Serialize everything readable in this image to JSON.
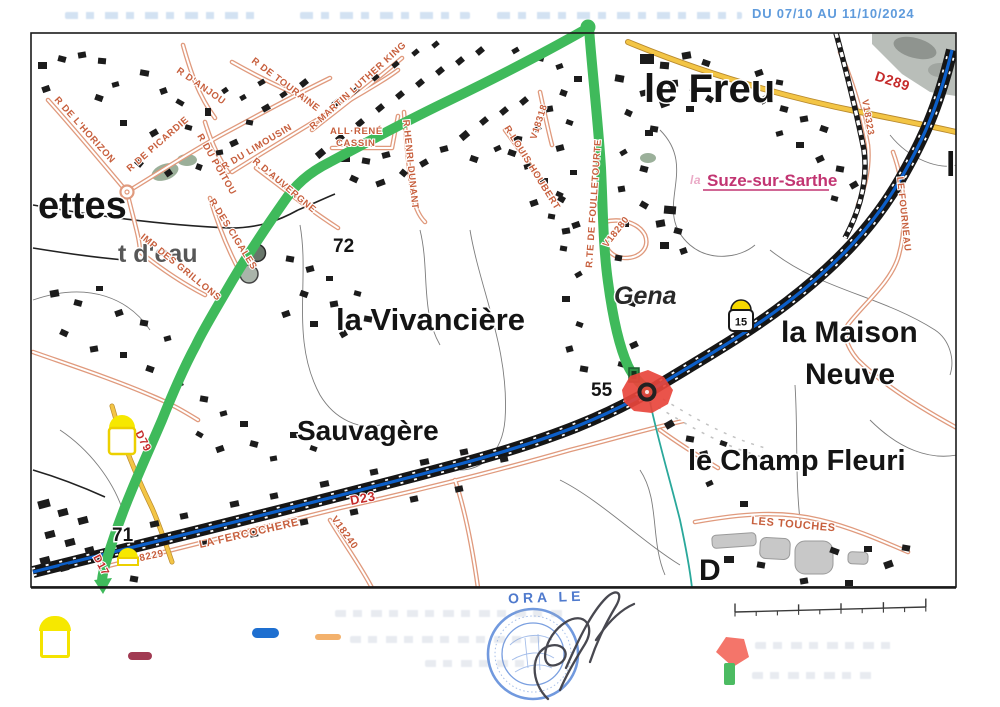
{
  "header": {
    "date_text": "DU 07/10 AU 11/10/2024"
  },
  "stamp": {
    "text": "ORA LE"
  },
  "map": {
    "labels": [
      {
        "t": "ettes",
        "x": 38,
        "y": 218,
        "s": 38,
        "c": "#141414"
      },
      {
        "t": "t d'eau",
        "x": 118,
        "y": 262,
        "s": 25,
        "c": "#575757"
      },
      {
        "t": "le Freu",
        "x": 644,
        "y": 102,
        "s": 40,
        "c": "#141414"
      },
      {
        "t": "72",
        "x": 333,
        "y": 252,
        "s": 19,
        "c": "#141414"
      },
      {
        "t": "la Vivancière",
        "x": 336,
        "y": 330,
        "s": 31,
        "c": "#141414"
      },
      {
        "t": "Gena",
        "x": 614,
        "y": 304,
        "s": 25,
        "c": "#2a2a2a",
        "i": true
      },
      {
        "t": "55",
        "x": 591,
        "y": 396,
        "s": 19,
        "c": "#141414"
      },
      {
        "t": "la Maison",
        "x": 781,
        "y": 342,
        "s": 30,
        "c": "#141414"
      },
      {
        "t": "Neuve",
        "x": 805,
        "y": 384,
        "s": 30,
        "c": "#141414"
      },
      {
        "t": "le Champ Fleuri",
        "x": 688,
        "y": 470,
        "s": 29,
        "c": "#141414"
      },
      {
        "t": "Sauvagère",
        "x": 297,
        "y": 440,
        "s": 28,
        "c": "#141414"
      },
      {
        "t": "71",
        "x": 112,
        "y": 541,
        "s": 19,
        "c": "#141414"
      },
      {
        "t": "le",
        "x": 946,
        "y": 176,
        "s": 34,
        "c": "#141414"
      },
      {
        "t": "D",
        "x": 699,
        "y": 580,
        "s": 30,
        "c": "#141414"
      },
      {
        "t": "R DE L'HORIZON",
        "x": 54,
        "y": 100,
        "r": 48
      },
      {
        "t": "R DE PICARDIE",
        "x": 130,
        "y": 172,
        "r": -41
      },
      {
        "t": "R D'ANJOU",
        "x": 176,
        "y": 72,
        "r": 35
      },
      {
        "t": "R DU POITOU",
        "x": 197,
        "y": 136,
        "r": 60
      },
      {
        "t": "R DU LIMOUSIN",
        "x": 224,
        "y": 170,
        "r": -31
      },
      {
        "t": "R DE TOURAINE",
        "x": 251,
        "y": 62,
        "r": 37
      },
      {
        "t": "R MARTIN LUTHER KING",
        "x": 313,
        "y": 130,
        "r": -42
      },
      {
        "t": "ALL·RENÉ",
        "x": 330,
        "y": 134
      },
      {
        "t": "CASSIN",
        "x": 336,
        "y": 146
      },
      {
        "t": "R HENRI DUNANT",
        "x": 403,
        "y": 120,
        "r": 84
      },
      {
        "t": "R D'AUVERGNE",
        "x": 252,
        "y": 162,
        "r": 40
      },
      {
        "t": "R DES CIGALES",
        "x": 209,
        "y": 201,
        "r": 58
      },
      {
        "t": "IMP DES GRILLONS",
        "x": 140,
        "y": 238,
        "r": 39
      },
      {
        "t": "V18318",
        "x": 536,
        "y": 140,
        "r": -72
      },
      {
        "t": "R LOUIS HOUBERT",
        "x": 504,
        "y": 128,
        "r": 58
      },
      {
        "t": "R.TE DE FOULLETOURTE",
        "x": 592,
        "y": 268,
        "r": -86
      },
      {
        "t": "V18280",
        "x": 607,
        "y": 248,
        "r": -52
      },
      {
        "t": "V18323",
        "x": 862,
        "y": 100,
        "r": 80
      },
      {
        "t": "LE FOURNEAU",
        "x": 897,
        "y": 177,
        "r": 84
      },
      {
        "t": "LA FERCOCHERE",
        "x": 200,
        "y": 548,
        "r": -13,
        "s": 11
      },
      {
        "t": "V18229",
        "x": 127,
        "y": 564,
        "r": -12,
        "s": 10
      },
      {
        "t": "V18240",
        "x": 331,
        "y": 519,
        "r": 54,
        "s": 10
      },
      {
        "t": "LES TOUCHES",
        "x": 751,
        "y": 524,
        "r": 5,
        "s": 11
      },
      {
        "t": "D289",
        "x": 874,
        "y": 80,
        "r": 18,
        "s": 14,
        "c": "#c52b2b"
      },
      {
        "t": "D23",
        "x": 351,
        "y": 505,
        "r": -11,
        "s": 13,
        "c": "#c52b2b"
      },
      {
        "t": "D79",
        "x": 135,
        "y": 433,
        "r": 62,
        "s": 11,
        "c": "#c52b2b"
      },
      {
        "t": "D17",
        "x": 93,
        "y": 557,
        "r": 62,
        "s": 11,
        "c": "#c52b2b"
      },
      {
        "t": "Suze-sur-Sarthe",
        "x": 707,
        "y": 186,
        "s": 17,
        "c": "#c23572",
        "u": true
      },
      {
        "t": "la",
        "x": 690,
        "y": 184,
        "s": 12,
        "c": "#eaaac6",
        "i": true
      }
    ],
    "markers": [
      {
        "style": "boxed",
        "cx": 741,
        "y": 303,
        "value": "15"
      },
      {
        "style": "tall",
        "cx": 122,
        "y": 414,
        "value": ""
      },
      {
        "style": "dome",
        "cx": 128,
        "y": 548,
        "value": ""
      }
    ]
  },
  "legend": {
    "swatches": [
      {
        "name": "pk-marker-yellow",
        "color": "#f6e800"
      },
      {
        "name": "maroon-road",
        "color": "#a13a52"
      },
      {
        "name": "blue-route",
        "color": "#1e6fd0"
      },
      {
        "name": "orange-road",
        "color": "#f2a85c"
      },
      {
        "name": "closure-red",
        "color": "#f4756a"
      },
      {
        "name": "deviation-green",
        "color": "#4cbb62"
      }
    ]
  },
  "colors": {
    "green_route": "#3fba5b",
    "blue_route": "#0c5fc9",
    "red_closure": "#e8453c",
    "street_orange": "#e09a7d",
    "label_orange": "#c75f3d",
    "road_yellow": "#f3c545",
    "town_magenta": "#c23572"
  }
}
